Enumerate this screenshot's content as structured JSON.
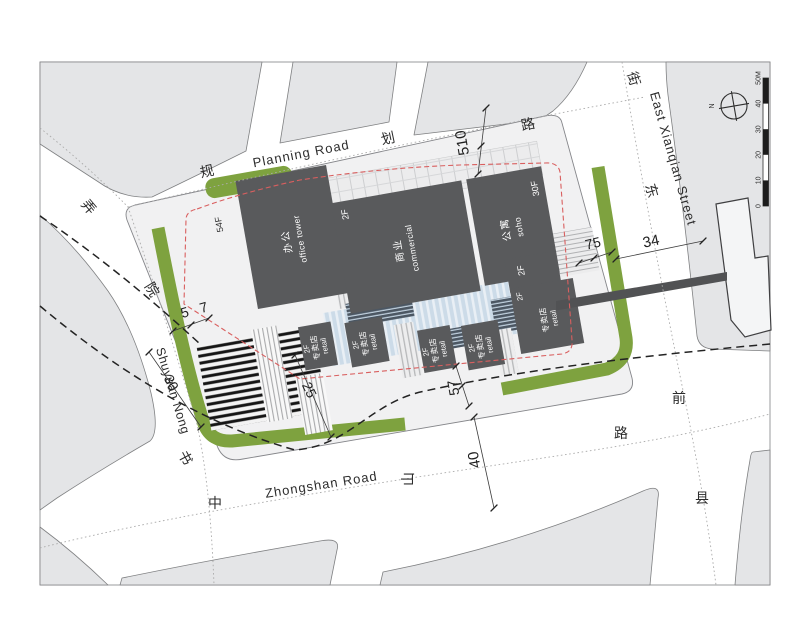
{
  "plan": {
    "roads": {
      "planning": {
        "en": "Planning Road",
        "zh": [
          "规",
          "划",
          "路"
        ]
      },
      "east_xianqian": {
        "en": "East Xianqian Street",
        "zh": [
          "东",
          "街",
          "前",
          "县"
        ]
      },
      "zhongshan": {
        "en": "Zhongshan Road",
        "zh": [
          "中",
          "山",
          "路"
        ]
      },
      "shuyuan": {
        "en": "Shuyuan Nong",
        "zh": [
          "书",
          "院",
          "弄"
        ]
      }
    },
    "buildings": {
      "office": {
        "floors": "54F",
        "zh": "办公",
        "en": "office tower"
      },
      "commercial": {
        "floors": "2F",
        "zh": "商业",
        "en": "commercial"
      },
      "soho": {
        "floors": "30F",
        "zh": "公寓",
        "en": "soho"
      },
      "annex": {
        "floors": "2F"
      },
      "retail": {
        "floors": "2F",
        "zh": "专卖店",
        "en": "retail"
      }
    },
    "dimensions": {
      "planning_offset": "510",
      "east_offset": "75",
      "xianqian_width": "34",
      "west_offset_a": "5",
      "west_offset_b": "7",
      "shuyuan_width": "30",
      "terrace_width": "25",
      "south_offset": "57",
      "zhongshan_width": "40"
    },
    "compass": {
      "north": "N"
    },
    "scalebar": {
      "labels": [
        "0",
        "10",
        "20",
        "30",
        "40",
        "50M"
      ]
    },
    "colors": {
      "building": "#595a5c",
      "block": "#e4e5e7",
      "green": "#7ea23f",
      "boundary_red": "#d95f5f",
      "plaza_blue": "#ccdbe8"
    }
  }
}
